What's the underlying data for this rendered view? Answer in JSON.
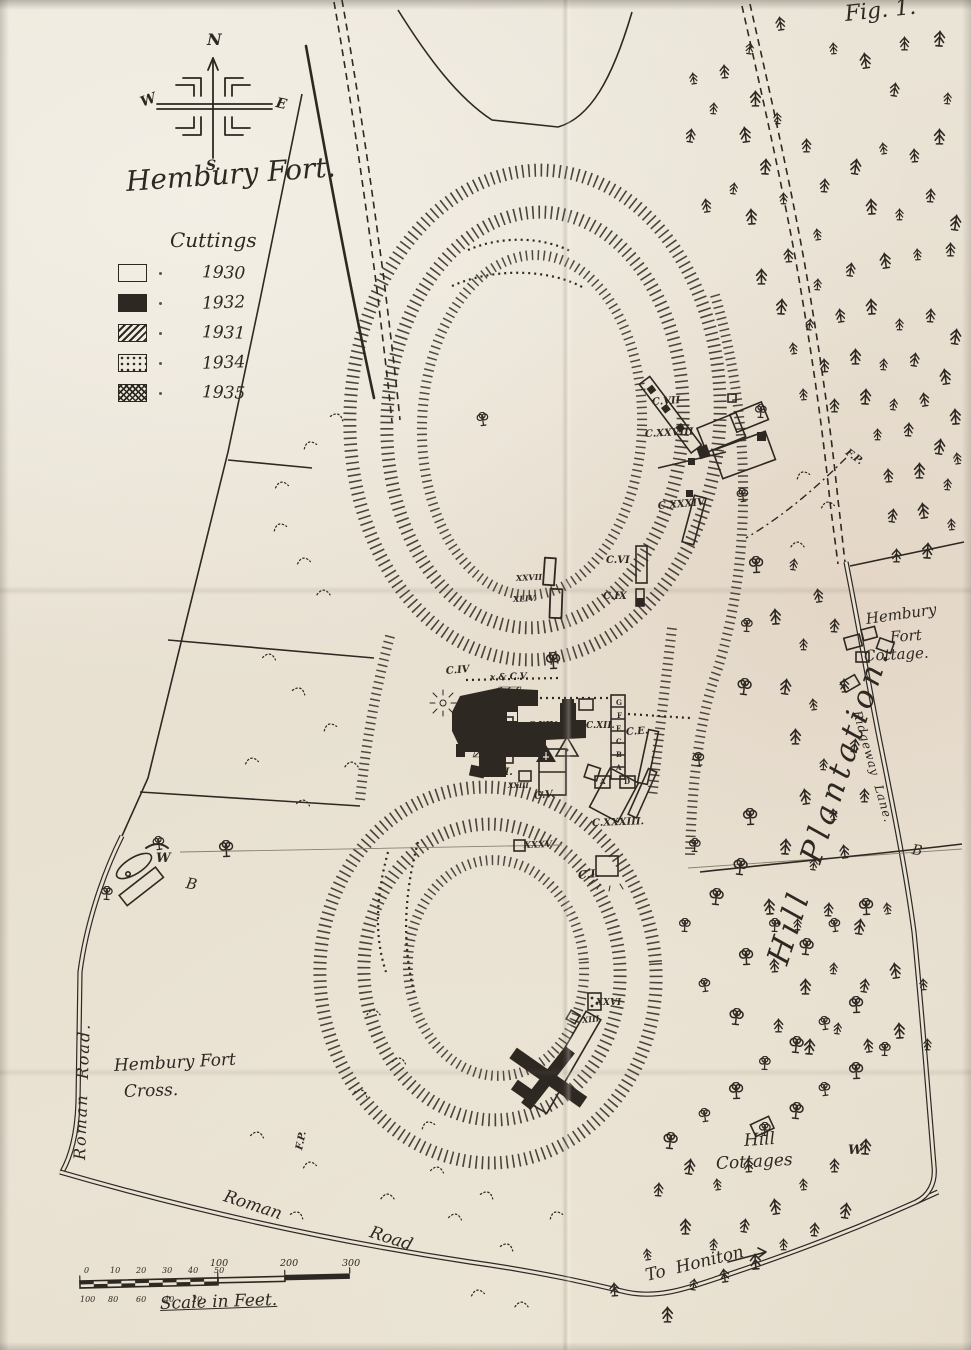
{
  "figure_label": "Fig. 1.",
  "title": "Hembury Fort.",
  "legend": {
    "title": "Cuttings",
    "items": [
      {
        "year": "1930",
        "pattern": "outline"
      },
      {
        "year": "1932",
        "pattern": "solid"
      },
      {
        "year": "1931",
        "pattern": "hatch"
      },
      {
        "year": "1934",
        "pattern": "dots"
      },
      {
        "year": "1935",
        "pattern": "crosshatch"
      }
    ]
  },
  "compass": {
    "north": "N",
    "east": "E",
    "south": "S.",
    "west": "W"
  },
  "scale_bar": {
    "label": "Scale in Feet.",
    "upper_ticks": [
      "0",
      "10",
      "20",
      "30",
      "40",
      "50"
    ],
    "main_ticks": [
      "100",
      "200",
      "300"
    ],
    "lower_ticks": [
      "100",
      "80",
      "60",
      "40",
      "20"
    ]
  },
  "colors": {
    "ink": "#2e2822",
    "paper": "#e9e3d6"
  },
  "labels": [
    {
      "n": "fig-number",
      "t": "Fig. 1.",
      "x": 845,
      "y": 4,
      "s": 22,
      "r": -6,
      "c": "hand"
    },
    {
      "n": "map-title",
      "t": "Hembury Fort.",
      "x": 126,
      "y": 168,
      "s": 28,
      "r": -4,
      "c": "hand"
    },
    {
      "n": "cottage-line-1",
      "t": "Hembury",
      "x": 866,
      "y": 612,
      "s": 15,
      "r": -8,
      "c": "hand"
    },
    {
      "n": "cottage-line-2",
      "t": "Fort",
      "x": 890,
      "y": 630,
      "s": 15,
      "r": -4,
      "c": "hand"
    },
    {
      "n": "cottage-line-3",
      "t": "Cottage.",
      "x": 864,
      "y": 649,
      "s": 15,
      "r": -3,
      "c": "hand"
    },
    {
      "n": "hill-plantation",
      "t": "Hill  Plantation.",
      "x": 778,
      "y": 948,
      "s": 31,
      "r": -72,
      "ls": 5,
      "c": "hand"
    },
    {
      "n": "ridgeway-lane",
      "t": "Ridgeway  Lane.",
      "x": 857,
      "y": 705,
      "s": 12,
      "r": 74,
      "ls": 1,
      "c": "hand"
    },
    {
      "n": "roman-road-left",
      "t": "Roman  Road.",
      "x": 80,
      "y": 1152,
      "s": 16,
      "r": -88,
      "ls": 2,
      "c": "hand"
    },
    {
      "n": "hembury-cross-1",
      "t": "Hembury Fort",
      "x": 114,
      "y": 1058,
      "s": 17,
      "r": -3,
      "c": "hand"
    },
    {
      "n": "hembury-cross-2",
      "t": "Cross.",
      "x": 124,
      "y": 1084,
      "s": 17,
      "r": -2,
      "c": "hand"
    },
    {
      "n": "roman-road-bottom-1",
      "t": "Roman",
      "x": 224,
      "y": 1188,
      "s": 17,
      "r": 18,
      "c": "hand"
    },
    {
      "n": "roman-road-bottom-2",
      "t": "Road",
      "x": 370,
      "y": 1224,
      "s": 17,
      "r": 18,
      "c": "hand"
    },
    {
      "n": "hill-cottages-1",
      "t": "Hill",
      "x": 744,
      "y": 1133,
      "s": 17,
      "r": -4,
      "c": "hand"
    },
    {
      "n": "hill-cottages-2",
      "t": "Cottages",
      "x": 716,
      "y": 1156,
      "s": 17,
      "r": -3,
      "c": "hand"
    },
    {
      "n": "to-honiton",
      "t": "To  Honiton",
      "x": 646,
      "y": 1268,
      "s": 17,
      "r": -14,
      "c": "hand"
    },
    {
      "n": "scale-label",
      "t": "Scale in Feet.",
      "x": 160,
      "y": 1296,
      "s": 17,
      "r": -2,
      "u": true,
      "c": "hand"
    },
    {
      "n": "letter-b-west",
      "t": "B",
      "x": 186,
      "y": 876,
      "s": 15,
      "r": 10,
      "c": "hand"
    },
    {
      "n": "letter-b-east",
      "t": "B",
      "x": 912,
      "y": 843,
      "s": 14,
      "r": 8,
      "c": "hand"
    },
    {
      "n": "cutting-c7",
      "t": "C.VII",
      "x": 652,
      "y": 398,
      "s": 10,
      "r": -4,
      "c": "cut"
    },
    {
      "n": "cutting-c28",
      "t": "C.XXVIII",
      "x": 645,
      "y": 430,
      "s": 10,
      "r": -3,
      "c": "cut"
    },
    {
      "n": "cutting-c34",
      "t": "C.XXXIV",
      "x": 658,
      "y": 502,
      "s": 10,
      "r": -5,
      "c": "cut"
    },
    {
      "n": "cutting-c6",
      "t": "C.VI",
      "x": 606,
      "y": 556,
      "s": 10,
      "r": 0,
      "c": "cut"
    },
    {
      "n": "cutting-c9",
      "t": "C.IX",
      "x": 603,
      "y": 592,
      "s": 10,
      "r": 0,
      "c": "cut"
    },
    {
      "n": "cutting-x27",
      "t": "XXVII",
      "x": 516,
      "y": 574,
      "s": 8,
      "r": -3,
      "c": "cut"
    },
    {
      "n": "cutting-x44",
      "t": "XLIV.",
      "x": 513,
      "y": 595,
      "s": 8,
      "r": -3,
      "c": "cut"
    },
    {
      "n": "cutting-c4",
      "t": "C.IV",
      "x": 446,
      "y": 667,
      "s": 10,
      "r": -5,
      "c": "cut"
    },
    {
      "n": "cutting-c5-north",
      "t": "x & C.V.",
      "x": 490,
      "y": 674,
      "s": 9,
      "r": -2,
      "c": "cut"
    },
    {
      "n": "cutting-c14",
      "t": "C.XIV.",
      "x": 528,
      "y": 722,
      "s": 9,
      "r": 0,
      "c": "cut"
    },
    {
      "n": "cutting-c12",
      "t": "C.XII.",
      "x": 586,
      "y": 722,
      "s": 9,
      "r": 0,
      "c": "cut"
    },
    {
      "n": "cutting-ce",
      "t": "C.E.",
      "x": 626,
      "y": 728,
      "s": 10,
      "r": -4,
      "c": "cut"
    },
    {
      "n": "cutting-c3",
      "t": "C.III.",
      "x": 484,
      "y": 768,
      "s": 10,
      "r": 0,
      "c": "cut"
    },
    {
      "n": "cutting-x23",
      "t": "XXIII",
      "x": 508,
      "y": 782,
      "s": 7,
      "r": 0,
      "c": "cut"
    },
    {
      "n": "cutting-c5-south",
      "t": "C.V.",
      "x": 534,
      "y": 792,
      "s": 10,
      "r": -6,
      "c": "cut"
    },
    {
      "n": "cutting-c33",
      "t": "C.XXXIII.",
      "x": 592,
      "y": 819,
      "s": 10,
      "r": -2,
      "c": "cut"
    },
    {
      "n": "cutting-x35",
      "t": "XXXV",
      "x": 524,
      "y": 842,
      "s": 9,
      "r": -2,
      "c": "cut"
    },
    {
      "n": "cutting-c1",
      "t": "C.I.",
      "x": 578,
      "y": 870,
      "s": 11,
      "r": -6,
      "c": "cut"
    },
    {
      "n": "cutting-x26",
      "t": "XXVI",
      "x": 596,
      "y": 999,
      "s": 9,
      "r": 0,
      "c": "cut"
    },
    {
      "n": "cutting-x13",
      "t": "XIII",
      "x": 582,
      "y": 1016,
      "s": 8,
      "r": -6,
      "c": "cut"
    },
    {
      "n": "fp-label-west",
      "t": "F.P.",
      "x": 300,
      "y": 1145,
      "s": 10,
      "r": -78,
      "c": "cut"
    },
    {
      "n": "fp-label-east",
      "t": "F.P.",
      "x": 846,
      "y": 447,
      "s": 10,
      "r": 36,
      "c": "cut"
    },
    {
      "n": "well-west",
      "t": "W",
      "x": 156,
      "y": 852,
      "s": 13,
      "r": 0,
      "c": "cut"
    },
    {
      "n": "well-east",
      "t": "W",
      "x": 848,
      "y": 1144,
      "s": 13,
      "r": 0,
      "c": "cut"
    },
    {
      "n": "trench-letter-g",
      "t": "G",
      "x": 616,
      "y": 699,
      "s": 7,
      "r": 0,
      "c": "tiny"
    },
    {
      "n": "trench-letter-f",
      "t": "F",
      "x": 617,
      "y": 712,
      "s": 7,
      "r": 0,
      "c": "tiny"
    },
    {
      "n": "trench-letter-e",
      "t": "E",
      "x": 616,
      "y": 725,
      "s": 7,
      "r": 0,
      "c": "tiny"
    },
    {
      "n": "trench-letter-c",
      "t": "C",
      "x": 616,
      "y": 738,
      "s": 7,
      "r": 0,
      "c": "tiny"
    },
    {
      "n": "trench-letter-b",
      "t": "B",
      "x": 616,
      "y": 751,
      "s": 7,
      "r": 0,
      "c": "tiny"
    },
    {
      "n": "trench-letter-a",
      "t": "A",
      "x": 616,
      "y": 764,
      "s": 7,
      "r": 0,
      "c": "tiny"
    },
    {
      "n": "trench-letter-box-a",
      "t": "A",
      "x": 600,
      "y": 778,
      "s": 7,
      "r": 0,
      "c": "tiny"
    },
    {
      "n": "trench-letter-box-d",
      "t": "D",
      "x": 624,
      "y": 778,
      "s": 7,
      "r": 0,
      "c": "tiny"
    }
  ]
}
